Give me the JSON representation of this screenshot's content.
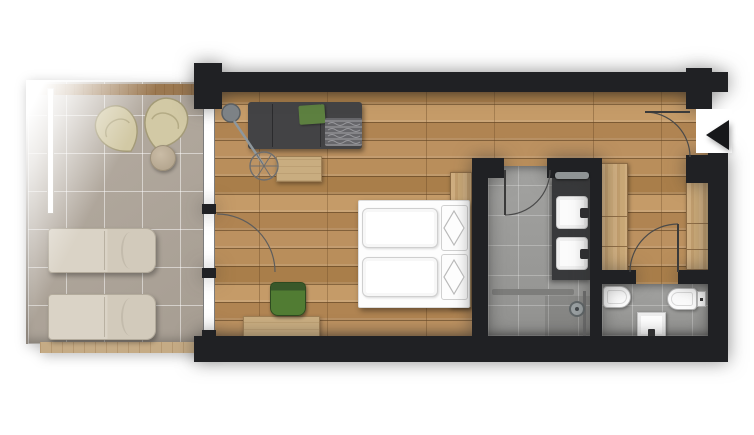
{
  "plan": {
    "type": "floor-plan",
    "view": "top-down",
    "label": "Hotel room floor plan"
  },
  "colors": {
    "background": "#ffffff",
    "wall": "#202124",
    "wood_floor": "#b58a55",
    "terrace_tile": "#aba295",
    "bath_tile": "#9d9d9b",
    "fixture_white": "#fcfcfc",
    "sofa_gray": "#434345",
    "accent_green": "#55803a",
    "furniture_wood": "#c9ad80",
    "lounger_beige": "#d8d1c4"
  },
  "rooms": {
    "terrace": {
      "label": "Terrace",
      "floor": "stone tiles",
      "items": {
        "lounge_chair_1": "lounge chair",
        "lounge_chair_2": "lounge chair",
        "side_table": "side table",
        "sun_lounger_1": "sun lounger",
        "sun_lounger_2": "sun lounger",
        "balustrade": "glass balustrade",
        "wood_edge_top": "wood deck edge",
        "wood_edge_bottom": "wood deck edge"
      }
    },
    "living_bedroom": {
      "label": "Living / Bedroom",
      "floor": "oak plank floor",
      "items": {
        "sofa": "sofa",
        "green_cushion": "green cushion",
        "throw": "throw blanket",
        "floor_lamp": "arc floor lamp",
        "coffee_table": "coffee table",
        "desk": "desk",
        "desk_chair": "green desk chair",
        "bed": "double bed",
        "mattress_1": "mattress",
        "mattress_2": "mattress",
        "pillow_1": "pillow",
        "pillow_2": "pillow",
        "headboard": "wood headboard panel",
        "terrace_door": "terrace door",
        "window": "window front"
      }
    },
    "bathroom": {
      "label": "Bathroom",
      "floor": "stone tiles",
      "items": {
        "vanity": "double vanity",
        "sink_1": "washbasin",
        "sink_2": "washbasin",
        "towel_rail": "towel rail",
        "shower_bench": "shower bench",
        "shower_screen": "glass screen",
        "shower_head": "shower fitting",
        "door": "bathroom door"
      }
    },
    "wc": {
      "label": "WC",
      "floor": "stone tiles",
      "items": {
        "toilet": "wall-hung toilet",
        "bidet": "bidet with flush plate",
        "basin": "washbasin",
        "door": "wc door"
      }
    },
    "hallway": {
      "label": "Hallway",
      "floor": "oak plank floor",
      "items": {
        "wardrobe_1": "wardrobe",
        "wardrobe_2": "wardrobe",
        "entry_door": "entrance door",
        "entrance_arrow": "entrance marker"
      }
    }
  }
}
